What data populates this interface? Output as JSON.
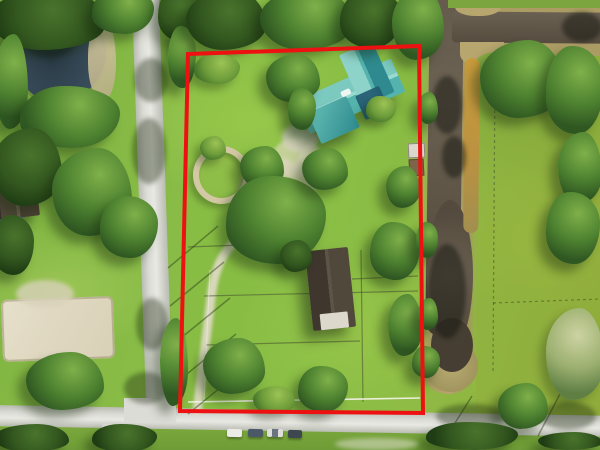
{
  "image": {
    "type": "aerial-drone-photograph",
    "width_px": 600,
    "height_px": 450,
    "description": "Top-down aerial photo of an equestrian-style residential parcel outlined in red, with a teal-roofed house, round pen, barn, sandy driveway and fenced paddocks; a street borders the west and south sides, a brown drainage canal runs along the east side, and a pond, sand arena and neighboring homes lie to the west."
  },
  "colors": {
    "boundary-red": "#ee1111",
    "grass-base": "#7fb341",
    "grass-bright": "#8fc24a",
    "grass-neighbor": "#8fae3c",
    "grass-south": "#7aa83c",
    "tree-dark": "#2f5722",
    "tree-mid": "#4e8230",
    "tree-light": "#7fb04a",
    "road-light": "#dcdcd6",
    "road-edge": "#b9bcb2",
    "sand": "#d9d2ba",
    "arena-sand": "#e6dfca",
    "pen-sand": "#d3c8a4",
    "pond-water": "#3a4e5c",
    "pond-deep": "#2c3c48",
    "canal-water": "#6b6152",
    "canal-water-dark": "#463e32",
    "canal-bank": "#ab9c64",
    "canal-gold": "#c89c3c",
    "roof-teal": "#54b3ac",
    "roof-teal-light": "#7cc9bf",
    "roof-teal-dark": "#2e8a8e",
    "roof-dark-brown": "#55493d",
    "barn-roof": "#51483c",
    "shed-white": "#dcd8cc",
    "trailer-white": "#eceae4",
    "car-dark": "#4b5868",
    "white-fence": "#f5f4ea"
  },
  "scene": {
    "parcel_outline": {
      "shape": "quadrilateral",
      "corners_px": [
        [
          188,
          54
        ],
        [
          419,
          46
        ],
        [
          423,
          413
        ],
        [
          180,
          411
        ]
      ],
      "stroke_px": 4
    },
    "landmarks": [
      {
        "name": "main-house",
        "note": "teal metal roof, multiple gables, upper middle of parcel"
      },
      {
        "name": "round-pen",
        "note": "tan circular ring on lawn left of house"
      },
      {
        "name": "barn",
        "note": "dark gabled roof, center-south of parcel"
      },
      {
        "name": "sand-driveway",
        "note": "enters from south road, runs up west side to center yard"
      },
      {
        "name": "paddock-fences",
        "note": "thin fence lines dividing south half of parcel"
      },
      {
        "name": "canal",
        "note": "brown water channel along east boundary with branch to northeast"
      },
      {
        "name": "pond",
        "note": "dark round pond, northwest corner of image"
      },
      {
        "name": "west-road",
        "note": "light gray street running north-south"
      },
      {
        "name": "south-road",
        "note": "light gray street running east-west"
      },
      {
        "name": "sand-arena",
        "note": "neighbor riding arena, southwest"
      },
      {
        "name": "neighbor-house-west",
        "note": "dark brown roof at left edge"
      },
      {
        "name": "neighbor-lawn-east",
        "note": "open lawn with trees and white trailer beyond canal"
      },
      {
        "name": "parked-cars",
        "count": 4,
        "note": "along south road"
      }
    ]
  }
}
